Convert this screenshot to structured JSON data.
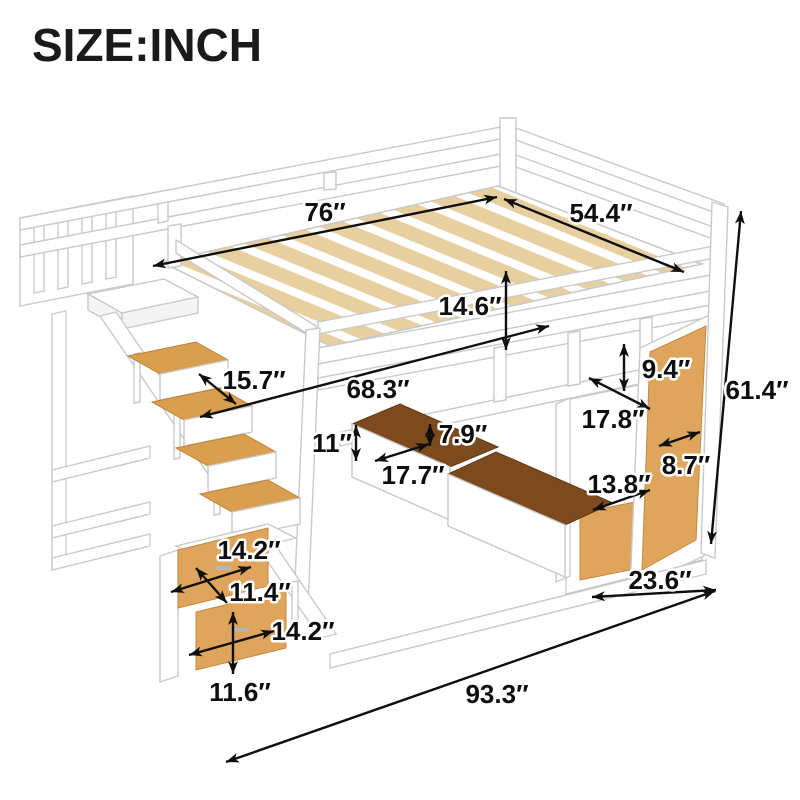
{
  "title": "SIZE:INCH",
  "figure": {
    "description": "Loft bed with staircase storage steps, shelves and under-bed drawers"
  },
  "colors": {
    "background": "#ffffff",
    "furniture_white": "#ffffff",
    "outline_gray": "#c9c9c9",
    "wood_panel": "#dfa55c",
    "stair_tread": "#d99f4f",
    "slat_wood": "#e7cfa0",
    "drawer_interior": "#7c4a1d",
    "dimension_black": "#0f0f0f"
  },
  "dimensions": [
    {
      "id": "bed-length",
      "label": "76″"
    },
    {
      "id": "bed-width",
      "label": "54.4″"
    },
    {
      "id": "guardrail-height",
      "label": "14.6″"
    },
    {
      "id": "landing-depth",
      "label": "15.7″"
    },
    {
      "id": "underbed-length",
      "label": "68.3″"
    },
    {
      "id": "cubby-height",
      "label": "9.4″"
    },
    {
      "id": "cubby-width",
      "label": "17.8″"
    },
    {
      "id": "drawer-section-height",
      "label": "11″"
    },
    {
      "id": "drawer-height",
      "label": "7.9″"
    },
    {
      "id": "drawer-depth",
      "label": "17.7″"
    },
    {
      "id": "side-shelf-width",
      "label": "8.7″"
    },
    {
      "id": "cabinet-width",
      "label": "13.8″"
    },
    {
      "id": "total-height",
      "label": "61.4″"
    },
    {
      "id": "stair-tread-width",
      "label": "14.2″"
    },
    {
      "id": "stair-step-height",
      "label": "11.4″"
    },
    {
      "id": "stair-drawer-width",
      "label": "14.2″"
    },
    {
      "id": "stair-drawer-height",
      "label": "11.6″"
    },
    {
      "id": "bed-depth",
      "label": "23.6″"
    },
    {
      "id": "total-length",
      "label": "93.3″"
    }
  ]
}
